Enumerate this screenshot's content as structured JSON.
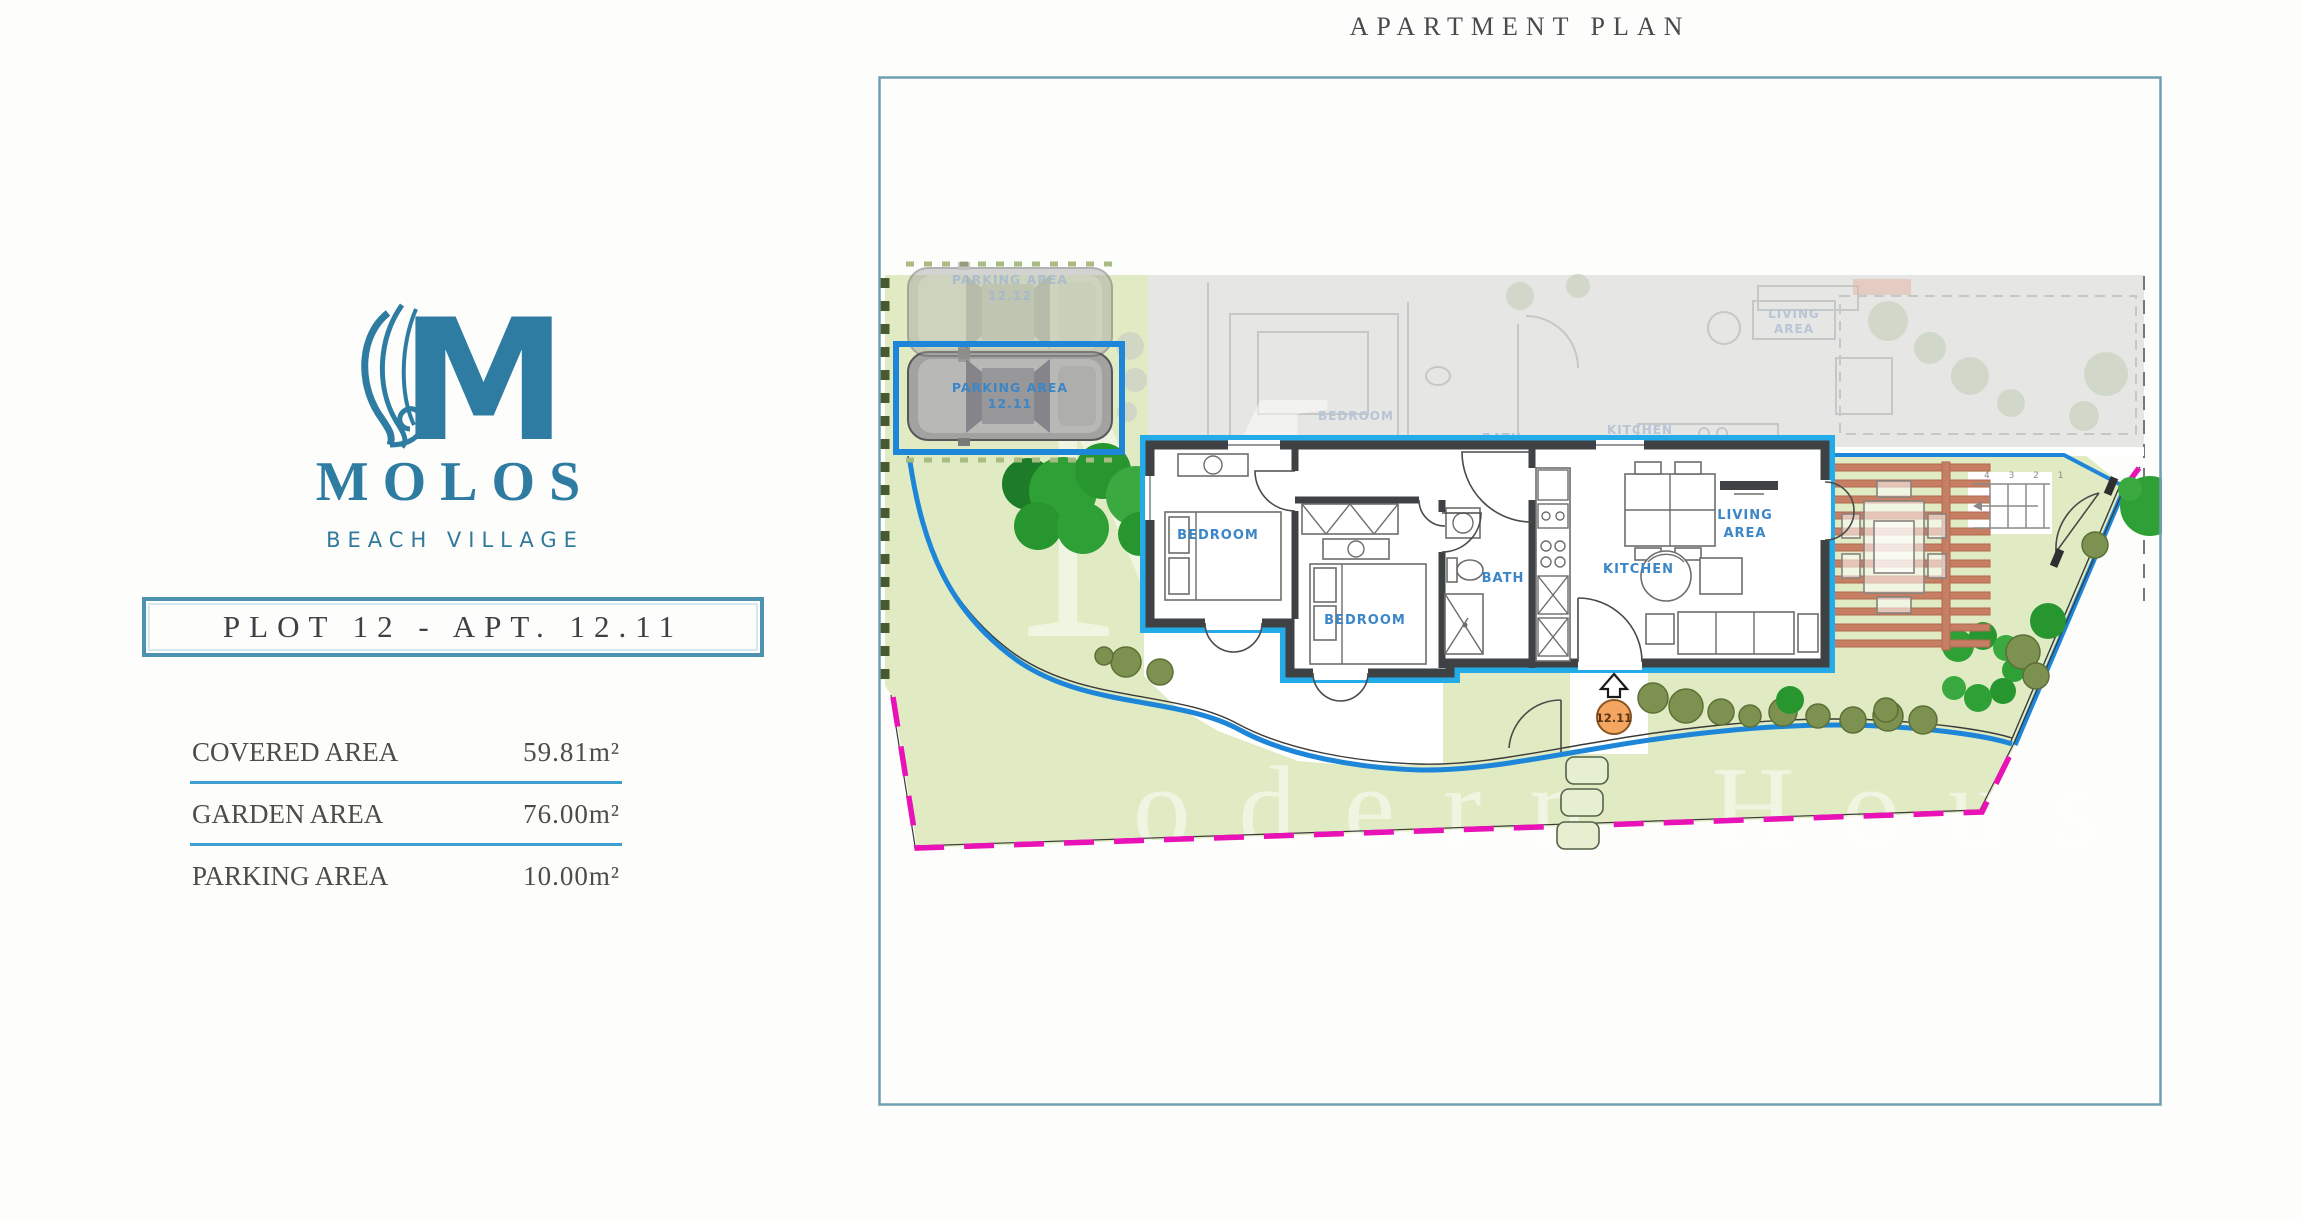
{
  "title": "APARTMENT PLAN",
  "brand": {
    "monogram": "M",
    "name": "MOLOS",
    "tagline": "BEACH VILLAGE"
  },
  "plot": {
    "label": "PLOT 12 - APT. 12.11"
  },
  "areas": [
    {
      "label": "COVERED AREA",
      "value": "59.81m²"
    },
    {
      "label": "GARDEN AREA",
      "value": "76.00m²"
    },
    {
      "label": "PARKING AREA",
      "value": "10.00m²"
    }
  ],
  "plan": {
    "parking_upper": {
      "line1": "PARKING AREA",
      "line2": "12.12"
    },
    "parking_selected": {
      "line1": "PARKING AREA",
      "line2": "12.11"
    },
    "rooms": {
      "bedroom1": "BEDROOM",
      "bedroom2": "BEDROOM",
      "bath": "BATH",
      "kitchen": "KITCHEN",
      "living_line1": "LIVING",
      "living_line2": "AREA"
    },
    "neighbor_rooms": {
      "bedroom": "BEDROOM",
      "bath": "BATH",
      "kitchen": "KITCHEN",
      "living_line1": "LIVING",
      "living_line2": "AREA"
    },
    "entrance_badge": "12.11",
    "stair_numbers": "4 3 2 1",
    "watermark": {
      "initial": "M",
      "word": "odern House"
    }
  },
  "colors": {
    "brand_teal": "#2e7ca2",
    "selection_blue": "#1e86d8",
    "boundary_magenta": "#e812b6",
    "garden_green": "#e0ebc3",
    "pergola_terracotta": "#c67f62"
  }
}
